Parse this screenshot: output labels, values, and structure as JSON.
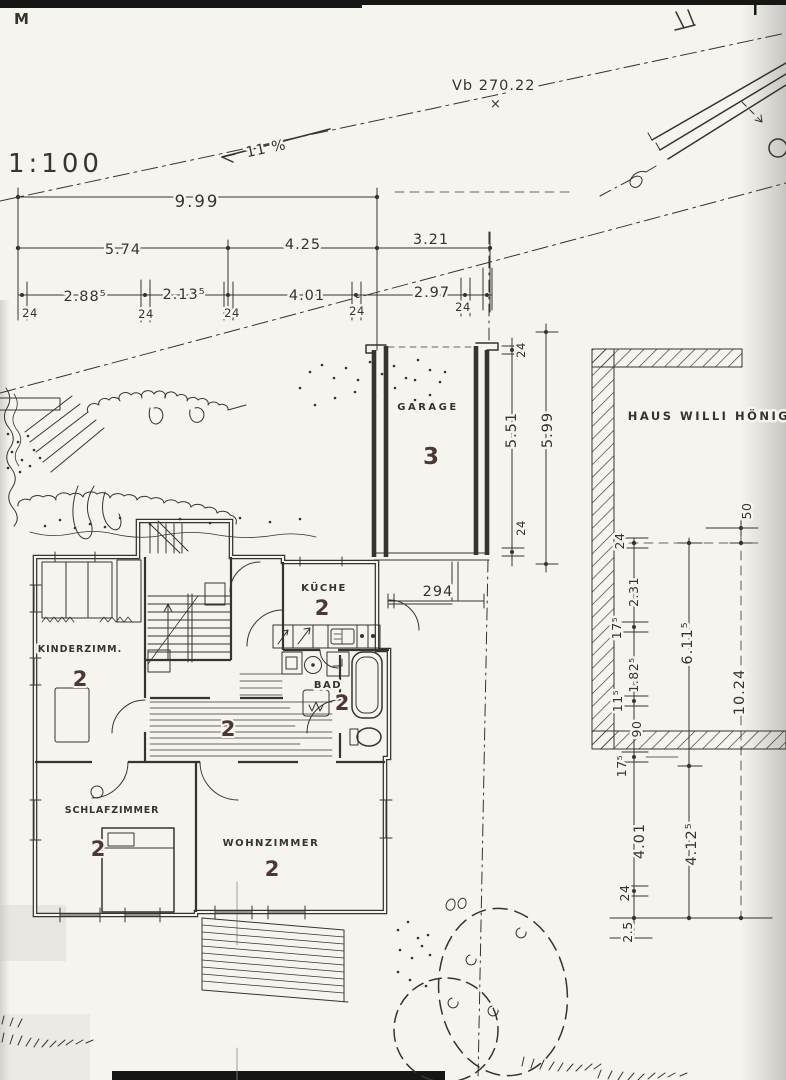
{
  "meta": {
    "sheet_mark": "M",
    "scale": "1:100",
    "slope": "11 %",
    "survey_point": "Vb 270.22",
    "survey_x": "×",
    "house_title": "HAUS WILLI HÖNIG"
  },
  "dims": {
    "row1": [
      "9.99"
    ],
    "row2": [
      "5.74",
      "4.25",
      "3.21"
    ],
    "row3": [
      "2.88⁵",
      "2.13⁵",
      "4.01",
      "2.97"
    ],
    "wall24": [
      "24",
      "24",
      "24",
      "24",
      "24"
    ],
    "garage_chain": [
      "24",
      "5.51",
      "5.99",
      "24"
    ],
    "kueche_width": "294",
    "right_chain_inner": [
      "24",
      "2.31",
      "17⁵",
      "1.82⁵",
      "11⁵",
      "90",
      "17⁵",
      "4.01",
      "24",
      "2.5"
    ],
    "right_chain_mid": [
      "6.11⁵",
      "4.12⁵"
    ],
    "right_chain_outer": [
      "50",
      "10.24"
    ]
  },
  "rooms": {
    "garage": {
      "name": "GARAGE",
      "number": "3"
    },
    "kueche": {
      "name": "KÜCHE",
      "number": "2"
    },
    "kinderzimmer": {
      "name": "KINDERZIMM.",
      "number": "2"
    },
    "bad": {
      "name": "BAD",
      "number": "2"
    },
    "flur": {
      "number": "2"
    },
    "schlafzimmer": {
      "name": "SCHLAFZIMMER",
      "number": "2"
    },
    "wohnzimmer": {
      "name": "WOHNZIMMER",
      "number": "2"
    }
  },
  "colors": {
    "ink": "#37332d",
    "number_ink": "#4b3733",
    "paper": "#f6f4ef"
  }
}
